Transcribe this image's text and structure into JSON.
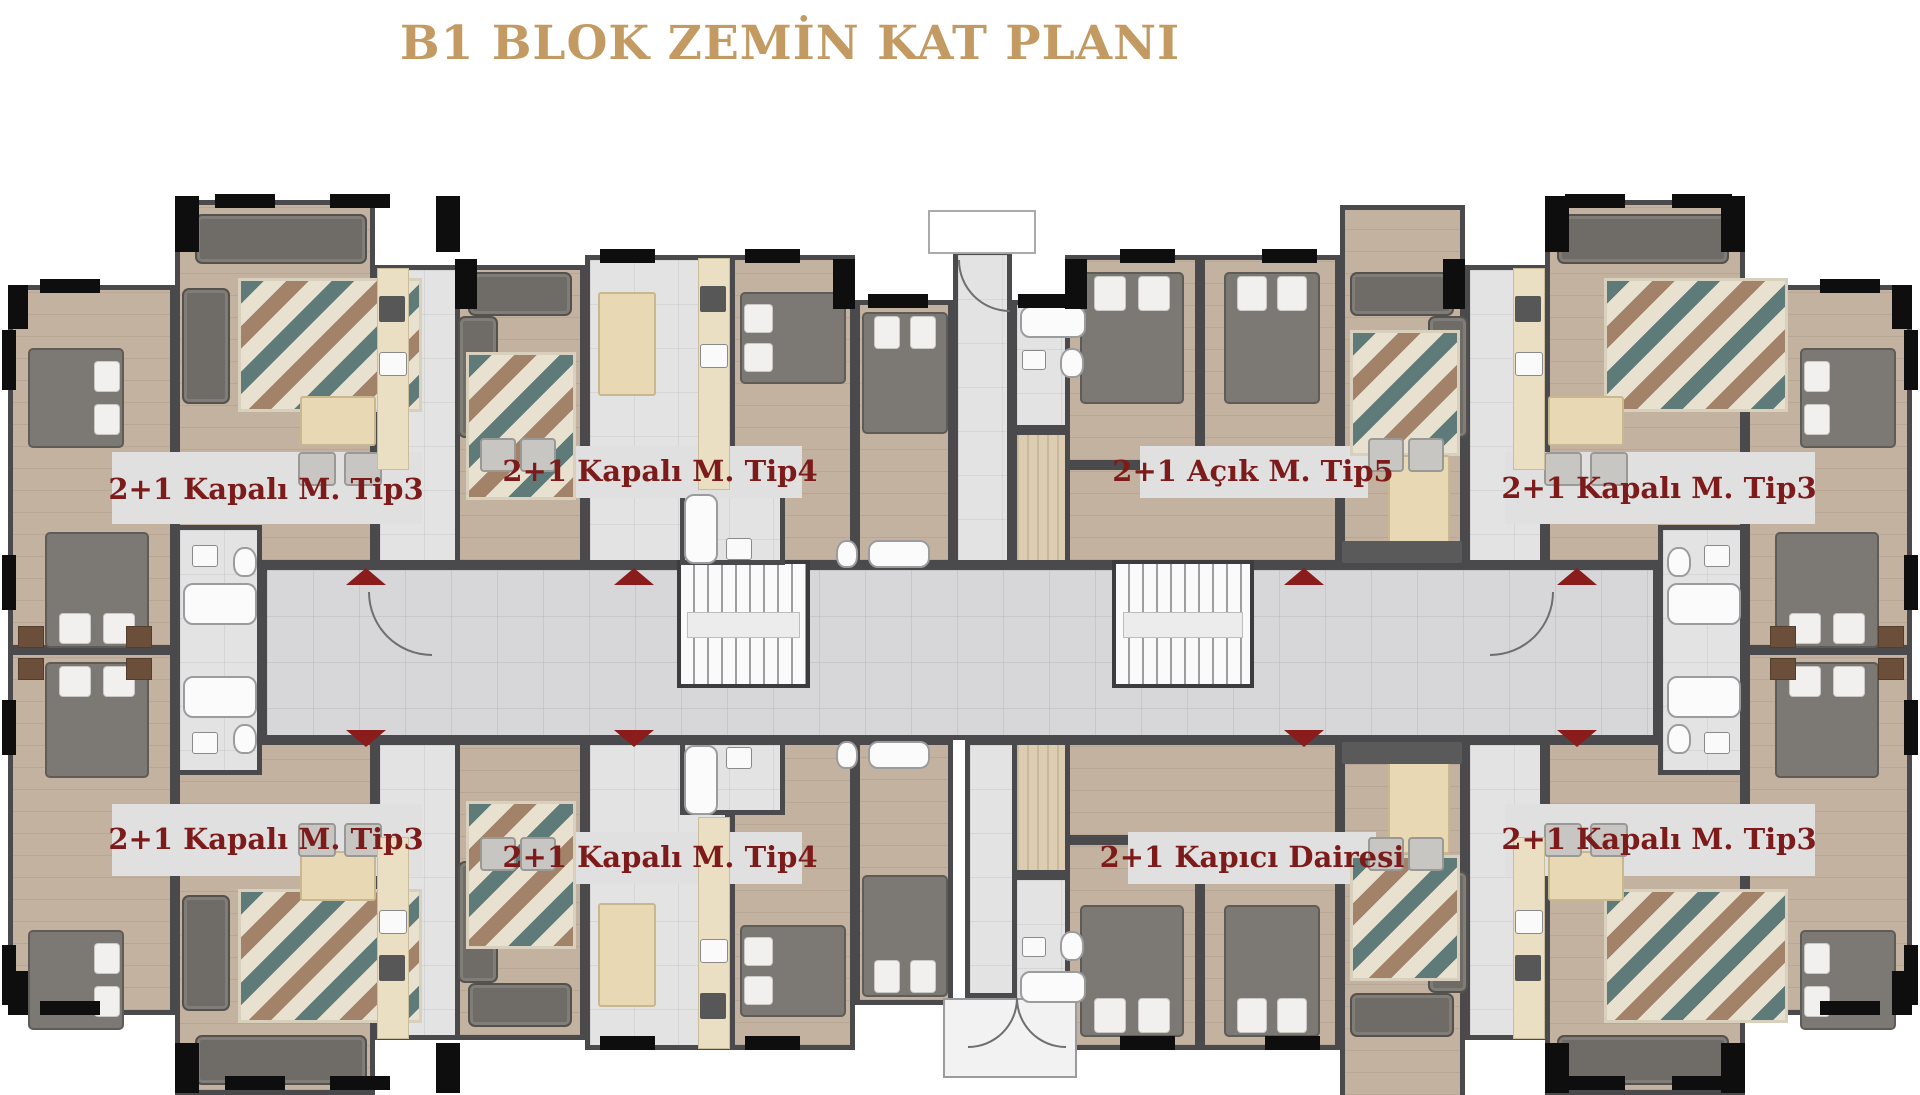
{
  "title": {
    "text": "B1 BLOK ZEMİN KAT PLANI"
  },
  "plan": {
    "unit_labels": [
      {
        "id": "tip3-top-left",
        "label": "2+1 Kapalı M. Tip3"
      },
      {
        "id": "tip4-top",
        "label": "2+1 Kapalı M. Tip4"
      },
      {
        "id": "tip5-top",
        "label": "2+1 Açık M. Tip5"
      },
      {
        "id": "tip3-top-right",
        "label": "2+1 Kapalı M. Tip3"
      },
      {
        "id": "tip3-bottom-left",
        "label": "2+1 Kapalı M. Tip3"
      },
      {
        "id": "tip4-bottom",
        "label": "2+1 Kapalı M. Tip4"
      },
      {
        "id": "kapici-dairesi",
        "label": "2+1 Kapıcı Dairesi"
      },
      {
        "id": "tip3-bottom-right",
        "label": "2+1 Kapalı M. Tip3"
      }
    ],
    "entrance_arrows": {
      "up_count": 4,
      "down_count": 4
    },
    "colors": {
      "title_gold": "#c49a63",
      "label_maroon": "#7d1a1a",
      "arrow_maroon": "#8a1c1c",
      "wood_floor": "#c3b2a0",
      "tile_floor": "#e3e3e4",
      "corridor_floor": "#d7d7d9",
      "wall": "#4a4a4c",
      "window_black": "#0e0e0e"
    }
  }
}
